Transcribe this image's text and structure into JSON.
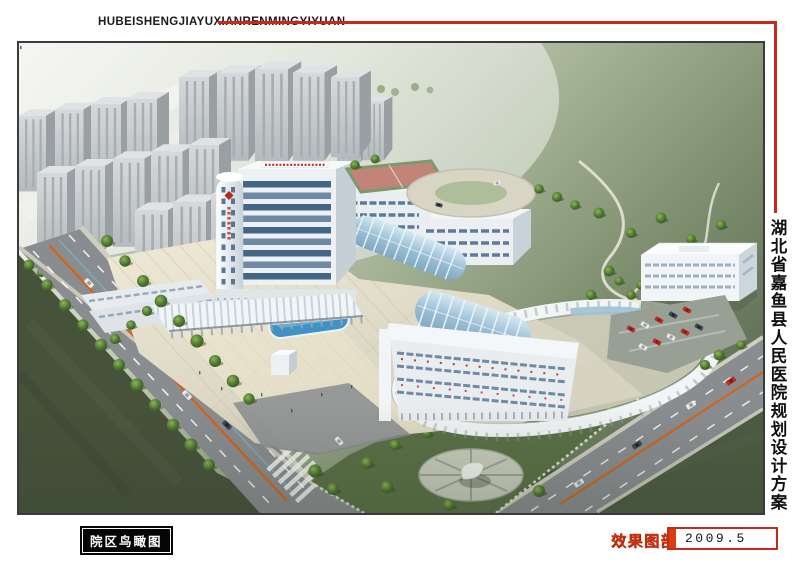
{
  "header": {
    "pinyin_title": "HUBEISHENGJIAYUXIANRENMINGYIYUAN"
  },
  "side": {
    "title": "湖北省嘉鱼县人民医院规划设计方案"
  },
  "footer": {
    "caption": "院区鸟瞰图",
    "section_label": "效果图部分",
    "date": "2009.5"
  },
  "colors": {
    "accent_red": "#c8291c",
    "date_bar_orange": "#d5400e",
    "section_label_red": "#c9310f",
    "caption_bg": "#000000",
    "caption_text": "#ffffff",
    "page_bg": "#ffffff"
  }
}
